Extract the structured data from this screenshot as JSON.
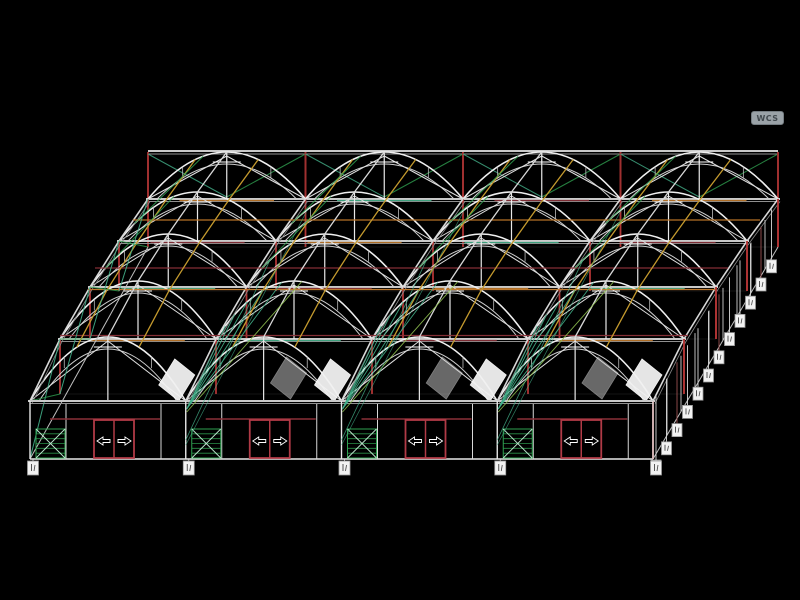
{
  "viewport": {
    "wcs_label": "WCS",
    "background": "#000000"
  },
  "drawing": {
    "type": "wireframe-greenhouse-multi-span-axonometric",
    "spans": 4,
    "bays": 4,
    "frames": {
      "eave_y": [
        401,
        339,
        287,
        241,
        199
      ],
      "left_x": [
        30,
        60,
        90,
        119,
        148
      ],
      "right_x": [
        653,
        684,
        716,
        747,
        778
      ],
      "arc_rise": [
        64,
        58,
        53,
        49,
        47
      ],
      "wall_h": [
        58,
        55,
        52,
        50,
        48
      ]
    },
    "ridge": {
      "y": 152,
      "x1": 148,
      "x2": 778
    },
    "front": {
      "ground_y": 459,
      "unit_mullions": [
        36,
        131
      ],
      "green_panel": {
        "offset": 6,
        "width": 29,
        "top": 429,
        "bottom": 458,
        "hatch_lines": 6
      },
      "door": {
        "offset": 64,
        "width": 40,
        "top": 420,
        "bottom": 458,
        "header_y": 419,
        "header_x1": 20,
        "header_x2": 130
      }
    },
    "purlins": {
      "t": [
        0.3,
        0.5,
        0.7
      ],
      "colors": [
        "#c49a2e",
        "#d8d8d8",
        "#c49a2e"
      ]
    },
    "accent_lines": [
      {
        "y": 220,
        "x1": 133,
        "x2": 760,
        "color": "#c07828"
      },
      {
        "y": 268,
        "x1": 95,
        "x2": 728,
        "color": "#8a3038"
      },
      {
        "y": 289.5,
        "x1": 88,
        "x2": 716,
        "color": "#c07828"
      },
      {
        "y": 335.5,
        "x1": 60,
        "x2": 688,
        "color": "#8a3038"
      }
    ],
    "vents": {
      "bright_spans": [
        1,
        2,
        3,
        4
      ],
      "dim_spans": [
        2,
        3,
        4
      ],
      "cy": 379
    },
    "markers": {
      "right": {
        "count": 12,
        "x0": 656,
        "dx": 10.5,
        "y0": 460,
        "dy": -18.2,
        "box_w": 10,
        "box_h": 13
      },
      "bottom": {
        "count": 5,
        "y": 461,
        "box_w": 11,
        "box_h": 14
      }
    },
    "colors": {
      "arc": "#f0f0f0",
      "arc_inner": "#cfcfcf",
      "beam": "#c9c9c9",
      "beam_shadow": "#8f8f8f",
      "column_red": "#b03434",
      "post_red": "#a03030",
      "door_red": "#b03a46",
      "header_maroon": "#8a3038",
      "green": "#2fa050",
      "teal": "#43b08a",
      "teal_light": "#bfe8d0",
      "lime": "#8fc050",
      "yellow": "#c49a2e",
      "orange": "#c07828",
      "white": "#ffffff",
      "gray": "#a8a8a8",
      "label_box": "#f2f2f2",
      "label_mark": "#444444"
    }
  }
}
